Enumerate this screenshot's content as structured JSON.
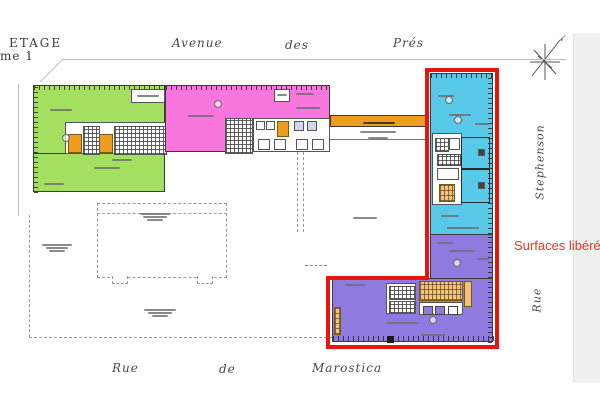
{
  "page": {
    "background": "#ffffff",
    "page_edge_color": "#f0f0f0"
  },
  "header": {
    "etage": "ETAGE",
    "etage_sub": "me 1"
  },
  "streets": {
    "top": {
      "words": [
        "Avenue",
        "des",
        "Prés"
      ]
    },
    "bottom": {
      "words": [
        "Rue",
        "de",
        "Marostica"
      ]
    },
    "right_vertical_top": "Stephenson",
    "right_vertical_bottom": "Rue"
  },
  "annotation": {
    "surfaces_label": "Surfaces libérées",
    "color": "#e2372c"
  },
  "plan": {
    "colors": {
      "green": "#a3e060",
      "pink": "#f876dd",
      "cyan": "#58c9e9",
      "purple": "#8f7bdf",
      "orange": "#f09c1e",
      "tan": "#f2c27d",
      "red_outline": "#e8140e",
      "wall": "#3a3a3a",
      "dash": "#9a9a9a"
    }
  }
}
